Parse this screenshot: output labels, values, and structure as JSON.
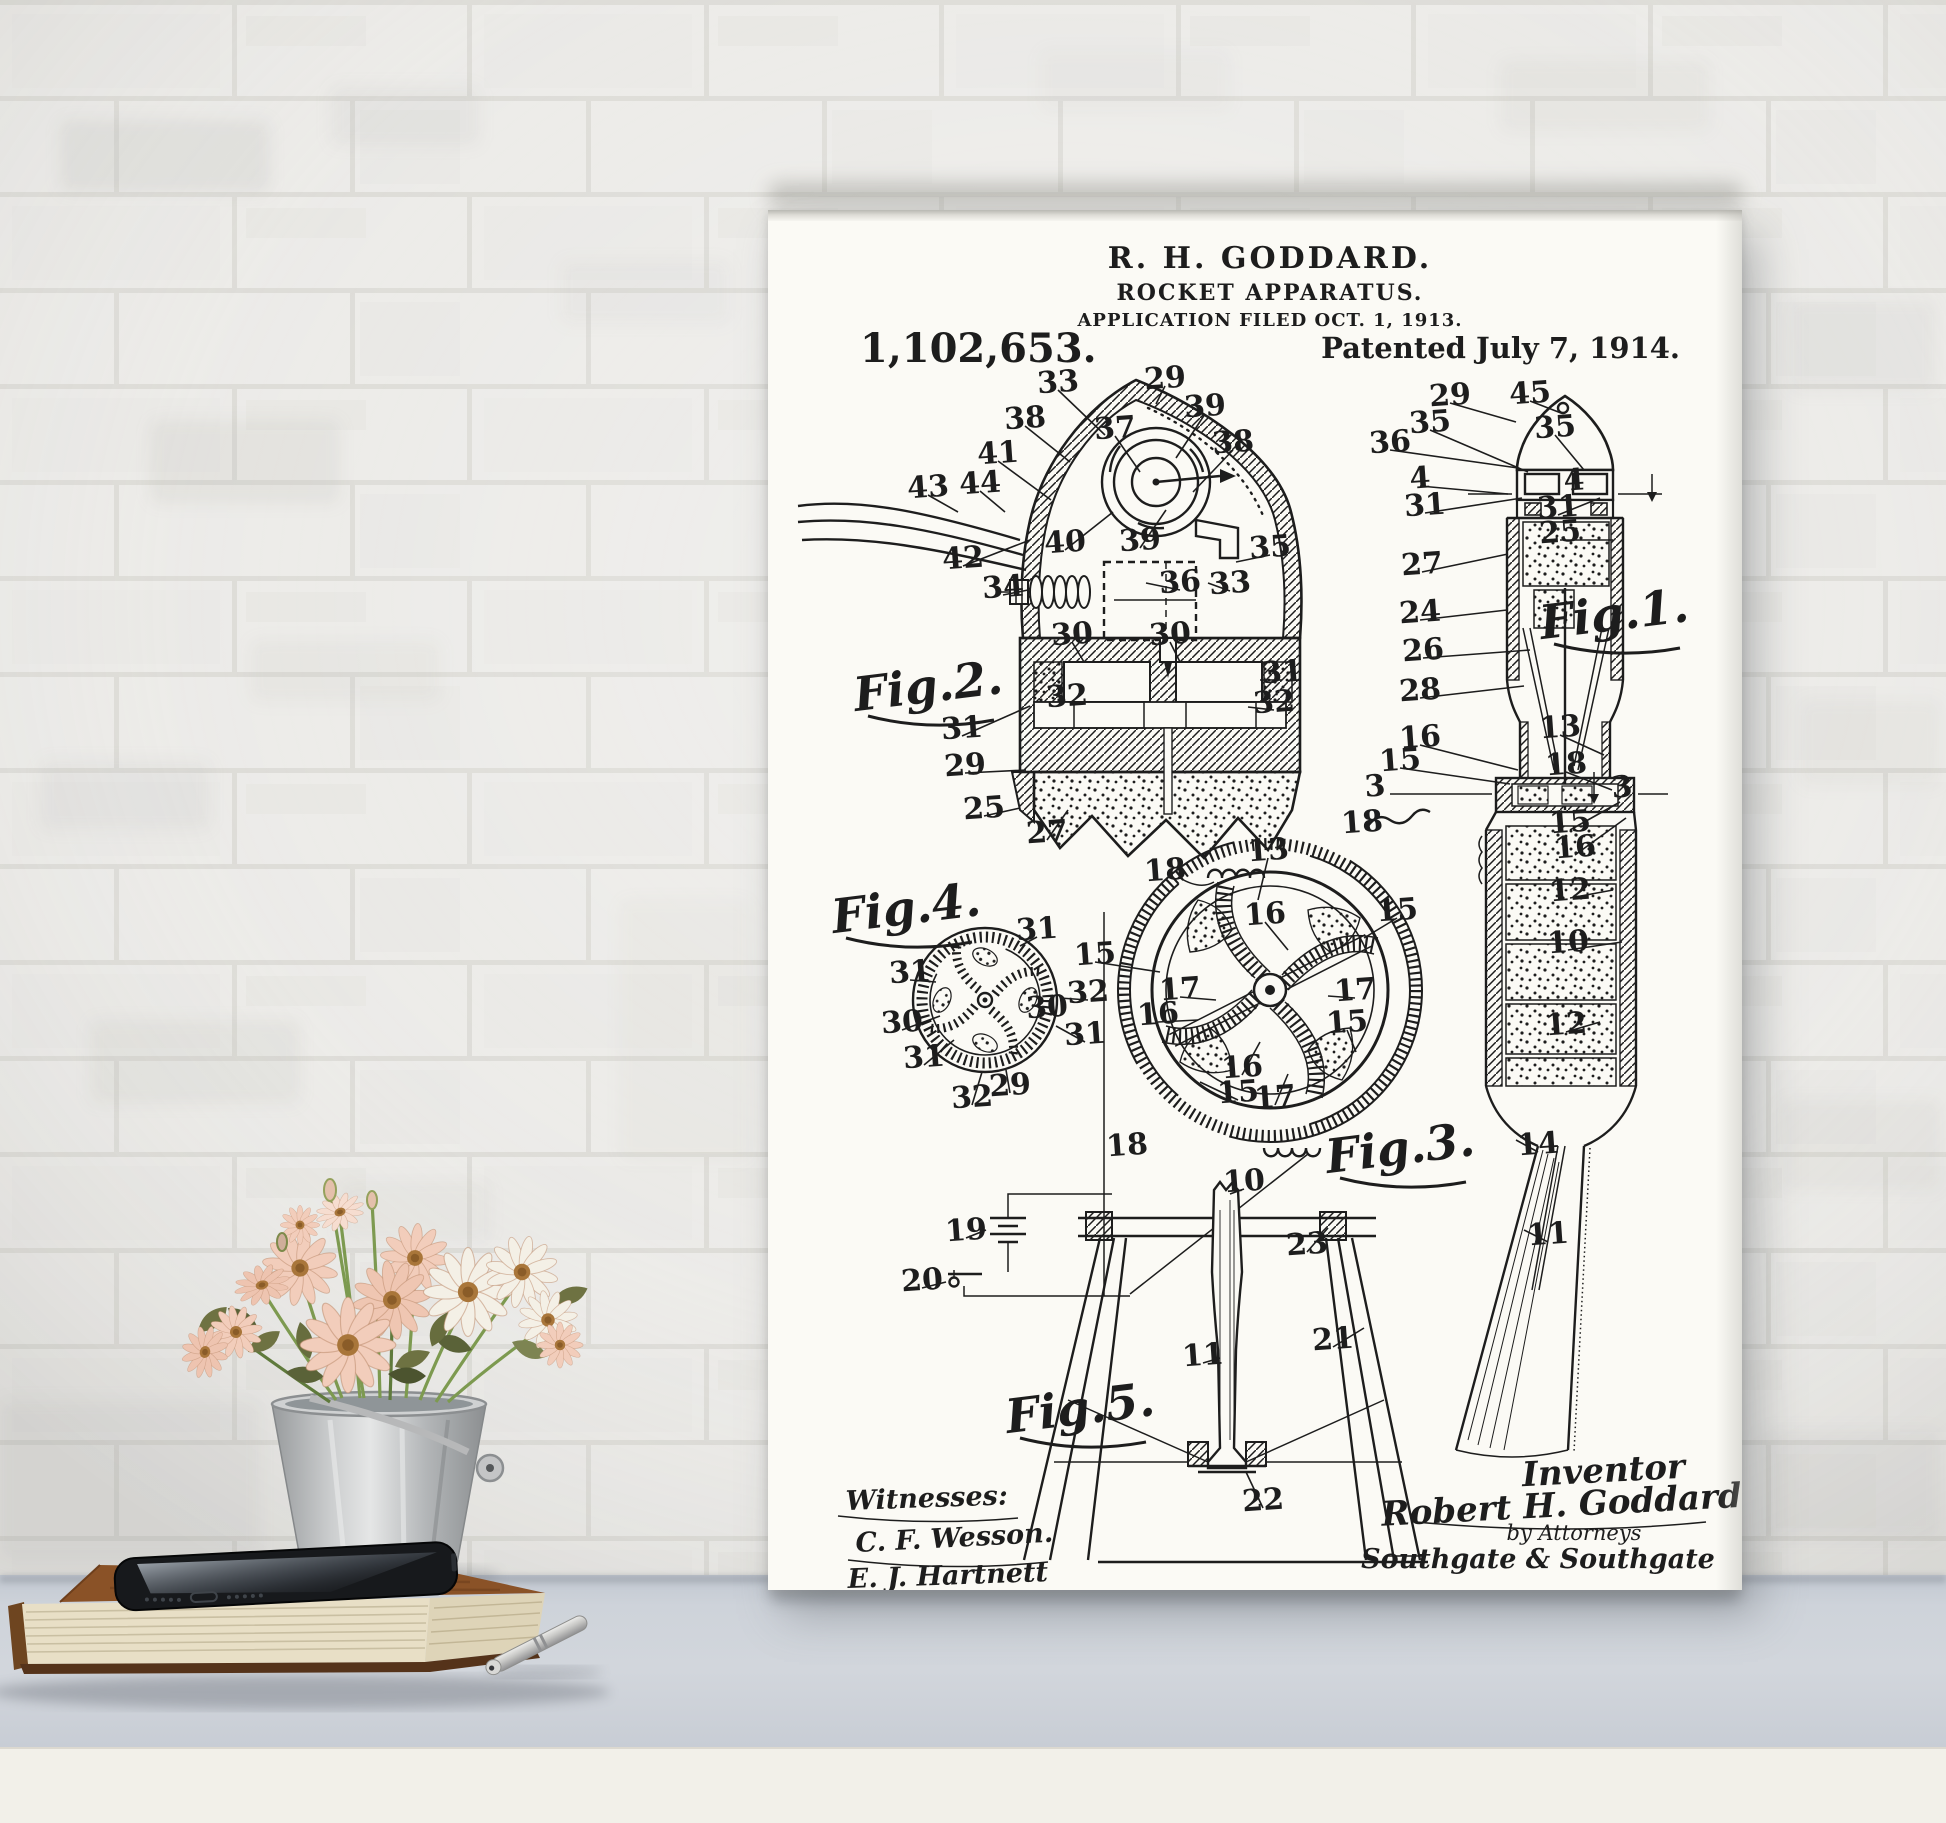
{
  "scene": {
    "description": "Patent art print leaning on a white desk against a whitewashed brick wall, with flowers in a zinc bucket, a vintage book, a smartphone and a silver pen",
    "colors": {
      "wall": "#ecebe8",
      "mortar": "#dddcd7",
      "desk_top": "#cdd2d9",
      "desk_front": "#f2f0e9",
      "poster_paper": "#fbfaf5",
      "ink": "#1d1d1d",
      "flower_peach": "#f2cdbb",
      "flower_white": "#f4f0e6",
      "flower_center": "#a9763a",
      "leaf": "#6e7242",
      "bucket": "#c6c8c9",
      "book_cover": "#8a5227",
      "book_pages": "#e8dfc6",
      "phone": "#17191c",
      "pen": "#c9c9c6"
    }
  },
  "poster": {
    "header": {
      "inventor_line": "R. H. GODDARD.",
      "title_line": "ROCKET APPARATUS.",
      "filed_line": "APPLICATION FILED OCT. 1, 1913.",
      "patent_number": "1,102,653.",
      "patented_line": "Patented July 7, 1914."
    },
    "figure_labels": [
      {
        "text": "Fig.2.",
        "x": 162,
        "y": 492
      },
      {
        "text": "Fig.4.",
        "x": 140,
        "y": 714
      },
      {
        "text": "Fig.1.",
        "x": 848,
        "y": 420
      },
      {
        "text": "Fig.3.",
        "x": 634,
        "y": 954
      },
      {
        "text": "Fig.5.",
        "x": 314,
        "y": 1214
      }
    ],
    "ref_labels": [
      {
        "t": "33",
        "x": 290,
        "y": 172,
        "lx": 337,
        "ly": 225
      },
      {
        "t": "29",
        "x": 397,
        "y": 168,
        "lx": 388,
        "ly": 194
      },
      {
        "t": "39",
        "x": 437,
        "y": 196,
        "lx": 408,
        "ly": 248
      },
      {
        "t": "38",
        "x": 257,
        "y": 208,
        "lx": 302,
        "ly": 252
      },
      {
        "t": "37",
        "x": 347,
        "y": 218,
        "lx": 372,
        "ly": 262
      },
      {
        "t": "38",
        "x": 465,
        "y": 232,
        "lx": 425,
        "ly": 282
      },
      {
        "t": "41",
        "x": 230,
        "y": 243,
        "lx": 283,
        "ly": 290
      },
      {
        "t": "43",
        "x": 160,
        "y": 277,
        "lx": 190,
        "ly": 302
      },
      {
        "t": "44",
        "x": 212,
        "y": 273,
        "lx": 237,
        "ly": 302
      },
      {
        "t": "40",
        "x": 297,
        "y": 332,
        "lx": 345,
        "ly": 302
      },
      {
        "t": "39",
        "x": 372,
        "y": 330,
        "lx": 398,
        "ly": 300
      },
      {
        "t": "42",
        "x": 195,
        "y": 348,
        "lx": 262,
        "ly": 330
      },
      {
        "t": "35",
        "x": 502,
        "y": 337,
        "lx": 468,
        "ly": 352
      },
      {
        "t": "34",
        "x": 235,
        "y": 377,
        "lx": 260,
        "ly": 380
      },
      {
        "t": "36",
        "x": 412,
        "y": 372,
        "lx": 378,
        "ly": 373
      },
      {
        "t": "33",
        "x": 462,
        "y": 373,
        "lx": 440,
        "ly": 373
      },
      {
        "t": "30",
        "x": 304,
        "y": 424,
        "lx": 316,
        "ly": 452
      },
      {
        "t": "30",
        "x": 402,
        "y": 424,
        "lx": 412,
        "ly": 452
      },
      {
        "t": "31",
        "x": 514,
        "y": 462,
        "lx": 492,
        "ly": 470
      },
      {
        "t": "32",
        "x": 506,
        "y": 492,
        "lx": 480,
        "ly": 497
      },
      {
        "t": "32",
        "x": 299,
        "y": 486
      },
      {
        "t": "31",
        "x": 194,
        "y": 518,
        "lx": 262,
        "ly": 496
      },
      {
        "t": "29",
        "x": 197,
        "y": 555,
        "lx": 258,
        "ly": 560
      },
      {
        "t": "25",
        "x": 216,
        "y": 598,
        "lx": 252,
        "ly": 598
      },
      {
        "t": "27",
        "x": 279,
        "y": 622,
        "lx": 300,
        "ly": 600
      },
      {
        "t": "29",
        "x": 682,
        "y": 185,
        "lx": 748,
        "ly": 212
      },
      {
        "t": "45",
        "x": 762,
        "y": 183,
        "lx": 793,
        "ly": 203
      },
      {
        "t": "35",
        "x": 662,
        "y": 212,
        "lx": 760,
        "ly": 262
      },
      {
        "t": "35",
        "x": 787,
        "y": 217,
        "lx": 816,
        "ly": 260
      },
      {
        "t": "36",
        "x": 622,
        "y": 232,
        "lx": 750,
        "ly": 258
      },
      {
        "t": "4",
        "x": 652,
        "y": 268,
        "lx": 740,
        "ly": 284
      },
      {
        "t": "4",
        "x": 806,
        "y": 270
      },
      {
        "t": "31",
        "x": 657,
        "y": 295,
        "lx": 754,
        "ly": 288
      },
      {
        "t": "31",
        "x": 790,
        "y": 297,
        "lx": 832,
        "ly": 288
      },
      {
        "t": "25",
        "x": 792,
        "y": 322,
        "lx": 845,
        "ly": 330
      },
      {
        "t": "27",
        "x": 654,
        "y": 354,
        "lx": 740,
        "ly": 344
      },
      {
        "t": "24",
        "x": 652,
        "y": 402,
        "lx": 739,
        "ly": 400
      },
      {
        "t": "26",
        "x": 655,
        "y": 440,
        "lx": 762,
        "ly": 440
      },
      {
        "t": "28",
        "x": 652,
        "y": 480,
        "lx": 756,
        "ly": 476
      },
      {
        "t": "16",
        "x": 652,
        "y": 527,
        "lx": 750,
        "ly": 560
      },
      {
        "t": "15",
        "x": 632,
        "y": 550,
        "lx": 742,
        "ly": 574
      },
      {
        "t": "3",
        "x": 607,
        "y": 576
      },
      {
        "t": "18",
        "x": 594,
        "y": 612
      },
      {
        "t": "13",
        "x": 792,
        "y": 517,
        "lx": 836,
        "ly": 545
      },
      {
        "t": "18",
        "x": 798,
        "y": 554,
        "lx": 844,
        "ly": 580
      },
      {
        "t": "3",
        "x": 854,
        "y": 577
      },
      {
        "t": "15",
        "x": 802,
        "y": 612,
        "lx": 852,
        "ly": 592
      },
      {
        "t": "16",
        "x": 807,
        "y": 637,
        "lx": 858,
        "ly": 608
      },
      {
        "t": "12",
        "x": 802,
        "y": 680,
        "lx": 845,
        "ly": 680
      },
      {
        "t": "10",
        "x": 800,
        "y": 732,
        "lx": 854,
        "ly": 732
      },
      {
        "t": "12",
        "x": 798,
        "y": 814,
        "lx": 832,
        "ly": 812
      },
      {
        "t": "14",
        "x": 770,
        "y": 934,
        "lx": 748,
        "ly": 930
      },
      {
        "t": "11",
        "x": 780,
        "y": 1024,
        "lx": 756,
        "ly": 1020
      },
      {
        "t": "31",
        "x": 269,
        "y": 719,
        "lx": 252,
        "ly": 736
      },
      {
        "t": "31",
        "x": 142,
        "y": 762,
        "lx": 168,
        "ly": 772
      },
      {
        "t": "32",
        "x": 320,
        "y": 782,
        "lx": 292,
        "ly": 788
      },
      {
        "t": "30",
        "x": 134,
        "y": 812,
        "lx": 172,
        "ly": 806
      },
      {
        "t": "30",
        "x": 279,
        "y": 797
      },
      {
        "t": "31",
        "x": 317,
        "y": 824,
        "lx": 288,
        "ly": 816
      },
      {
        "t": "31",
        "x": 156,
        "y": 847,
        "lx": 186,
        "ly": 830
      },
      {
        "t": "32",
        "x": 204,
        "y": 887,
        "lx": 214,
        "ly": 862
      },
      {
        "t": "29",
        "x": 242,
        "y": 875,
        "lx": 238,
        "ly": 860
      },
      {
        "t": "13",
        "x": 500,
        "y": 640,
        "lx": 490,
        "ly": 690
      },
      {
        "t": "18",
        "x": 397,
        "y": 660
      },
      {
        "t": "16",
        "x": 497,
        "y": 704,
        "lx": 520,
        "ly": 740
      },
      {
        "t": "15",
        "x": 629,
        "y": 700,
        "lx": 596,
        "ly": 728
      },
      {
        "t": "15",
        "x": 327,
        "y": 744,
        "lx": 392,
        "ly": 762
      },
      {
        "t": "17",
        "x": 412,
        "y": 779,
        "lx": 448,
        "ly": 790
      },
      {
        "t": "16",
        "x": 390,
        "y": 804,
        "lx": 430,
        "ly": 810
      },
      {
        "t": "17",
        "x": 587,
        "y": 780,
        "lx": 560,
        "ly": 786
      },
      {
        "t": "15",
        "x": 579,
        "y": 812,
        "lx": 588,
        "ly": 842
      },
      {
        "t": "16",
        "x": 474,
        "y": 857,
        "lx": 492,
        "ly": 832
      },
      {
        "t": "15",
        "x": 470,
        "y": 882,
        "lx": 432,
        "ly": 872
      },
      {
        "t": "17",
        "x": 507,
        "y": 887,
        "lx": 520,
        "ly": 864
      },
      {
        "t": "18",
        "x": 359,
        "y": 935
      },
      {
        "t": "10",
        "x": 476,
        "y": 971,
        "lx": 462,
        "ly": 984
      },
      {
        "t": "19",
        "x": 198,
        "y": 1020,
        "lx": 218,
        "ly": 1020
      },
      {
        "t": "20",
        "x": 154,
        "y": 1070,
        "lx": 178,
        "ly": 1072
      },
      {
        "t": "23",
        "x": 539,
        "y": 1034,
        "lx": 560,
        "ly": 1018
      },
      {
        "t": "11",
        "x": 435,
        "y": 1145,
        "lx": 452,
        "ly": 1148
      },
      {
        "t": "21",
        "x": 565,
        "y": 1129,
        "lx": 596,
        "ly": 1118
      },
      {
        "t": "22",
        "x": 495,
        "y": 1290,
        "lx": 478,
        "ly": 1262
      }
    ],
    "witnesses": {
      "heading": "Witnesses:",
      "signatures": [
        "C. F. Wesson.",
        "E. J. Hartnett"
      ]
    },
    "signature_block": {
      "role": "Inventor",
      "name": "Robert H. Goddard.",
      "by_line": "by Attorneys",
      "firm": "Southgate & Southgate"
    }
  },
  "objects": {
    "wall": "white-brick-wall",
    "art": "goddard-rocket-patent-print",
    "vase": "zinc-bucket-with-daisies",
    "book": "vintage-hardcover-book",
    "phone": "black-smartphone",
    "pen": "silver-pen"
  }
}
